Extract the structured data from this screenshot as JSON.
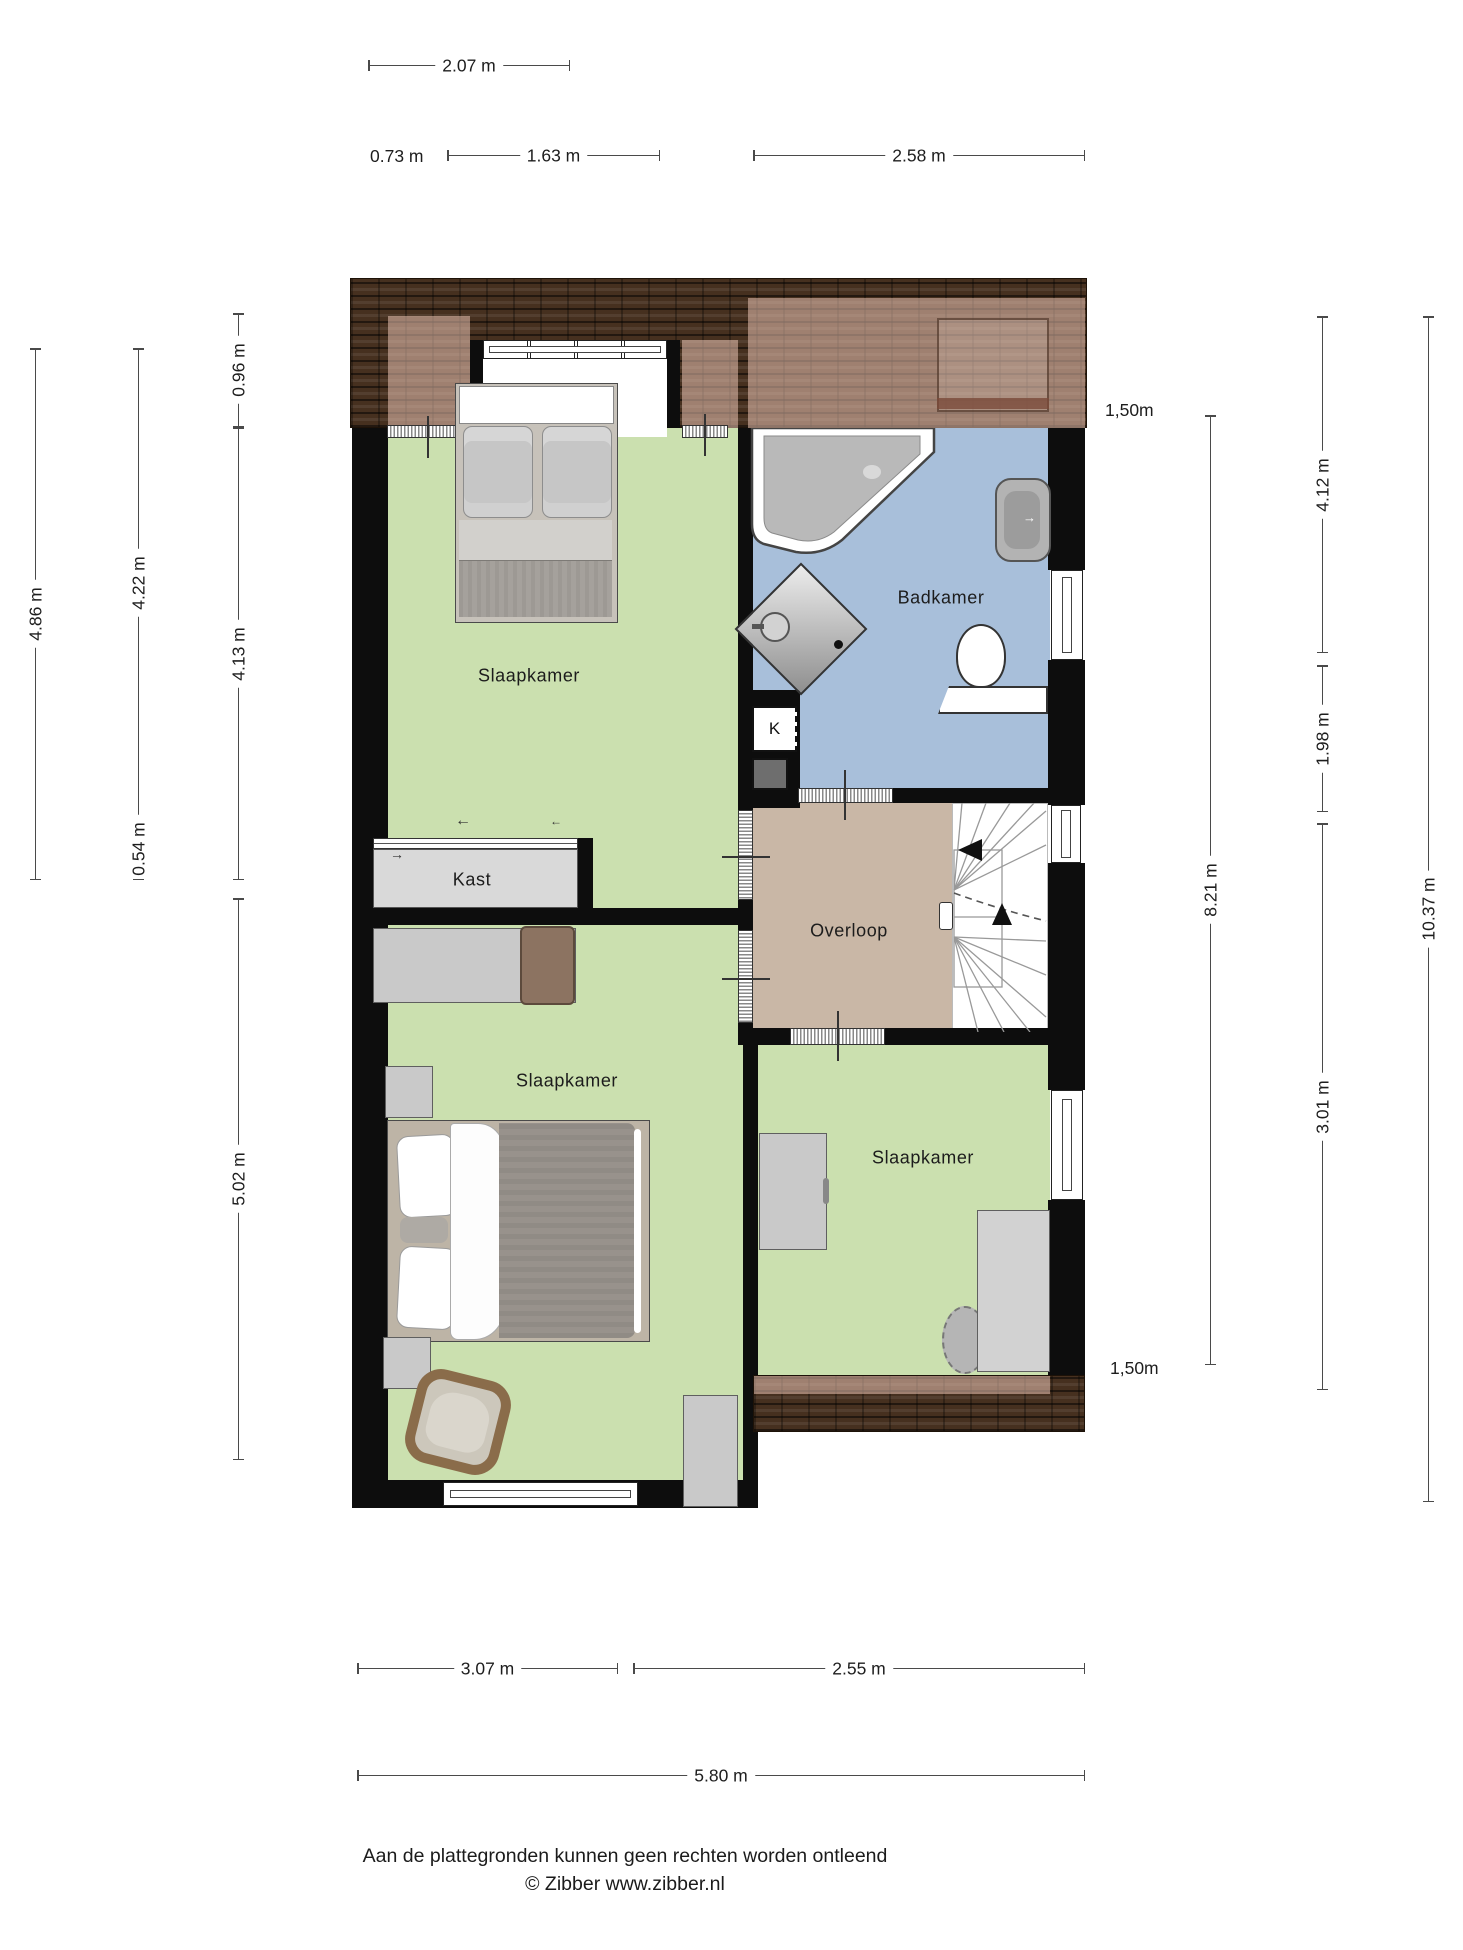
{
  "rooms": {
    "bedroom_top": "Slaapkamer",
    "bathroom": "Badkamer",
    "closet": "Kast",
    "k_closet": "K",
    "landing": "Overloop",
    "bedroom_middle": "Slaapkamer",
    "bedroom_right": "Slaapkamer"
  },
  "dimensions": {
    "top": {
      "dormer_total": "2.07 m",
      "offset": "0.73 m",
      "dormer_window": "1.63 m",
      "right_section": "2.58 m"
    },
    "left": {
      "outer_height": "4.86 m",
      "room_top_height": "4.22 m",
      "roof_edge": "0.96 m",
      "room_inner_height": "4.13 m",
      "closet_depth": "0.54 m",
      "room_bottom_height": "5.02 m"
    },
    "right": {
      "height_marker_top": "1,50m",
      "bath_height": "4.12 m",
      "mid_height": "8.21 m",
      "landing_height": "1.98 m",
      "bedroom_height": "3.01 m",
      "total_height": "10.37 m",
      "height_marker_bottom": "1,50m"
    },
    "bottom": {
      "left_width": "3.07 m",
      "right_width": "2.55 m",
      "total_width": "5.80 m"
    }
  },
  "footer": {
    "disclaimer": "Aan de plattegronden kunnen geen rechten worden ontleend",
    "credit": "© Zibber www.zibber.nl"
  },
  "colors": {
    "wall": "#0d0d0d",
    "floor_bedroom": "#cbe0af",
    "floor_bathroom": "#a8bfda",
    "floor_landing": "#c9b7a6",
    "roof": "#46301f",
    "roof_light": "#d9a892",
    "dim": "#4a4a4a"
  }
}
